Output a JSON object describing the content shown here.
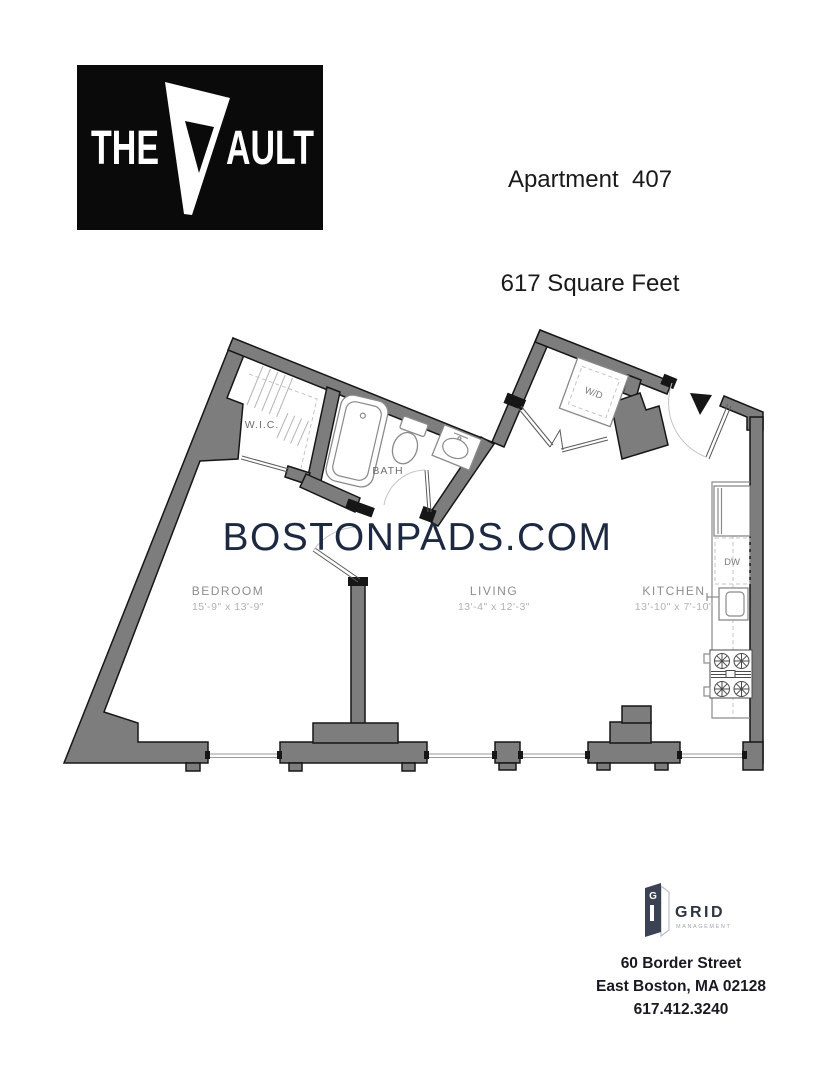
{
  "logo": {
    "word_the": "THE",
    "letter_v": "V",
    "word_ault": "AULT"
  },
  "header": {
    "line1": "Apartment  407",
    "line2": "617 Square Feet"
  },
  "watermark": {
    "text": "BOSTONPADS.COM",
    "color": "#1d2940"
  },
  "floorplan": {
    "wall_color": "#7d7d7d",
    "labels": {
      "wic": "W.I.C.",
      "bath": "BATH",
      "wd": "W/D",
      "dw": "DW",
      "bedroom": {
        "name": "BEDROOM",
        "dims": "15'-9\" x 13'-9\""
      },
      "living": {
        "name": "LIVING",
        "dims": "13'-4\" x 12'-3\""
      },
      "kitchen": {
        "name": "KITCHEN",
        "dims": "13'-10\" x 7'-10\""
      }
    }
  },
  "footer": {
    "brand": "GRID",
    "brand_sub": "MANAGEMENT",
    "brand_initial": "G",
    "address1": "60 Border Street",
    "address2": "East Boston, MA 02128",
    "phone": "617.412.3240"
  }
}
